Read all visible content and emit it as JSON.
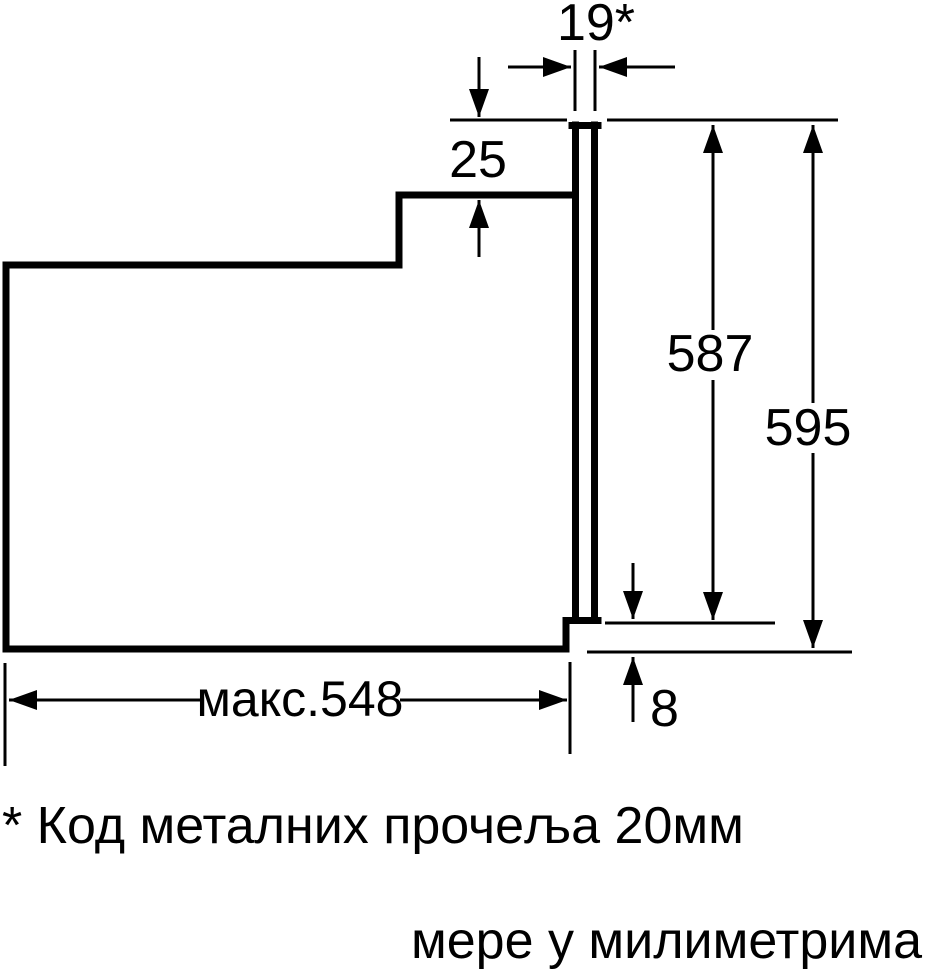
{
  "page": {
    "background": "#ffffff",
    "line_color": "#000000",
    "footnote": "* Код металних прочеља 20мм",
    "units_caption": "мере у милиметрима"
  },
  "dimensions": {
    "front_panel_depth": "19*",
    "top_recess": "25",
    "niche_height": "587",
    "overall_height": "595",
    "bottom_clearance": "8",
    "max_depth": "макс.548"
  }
}
